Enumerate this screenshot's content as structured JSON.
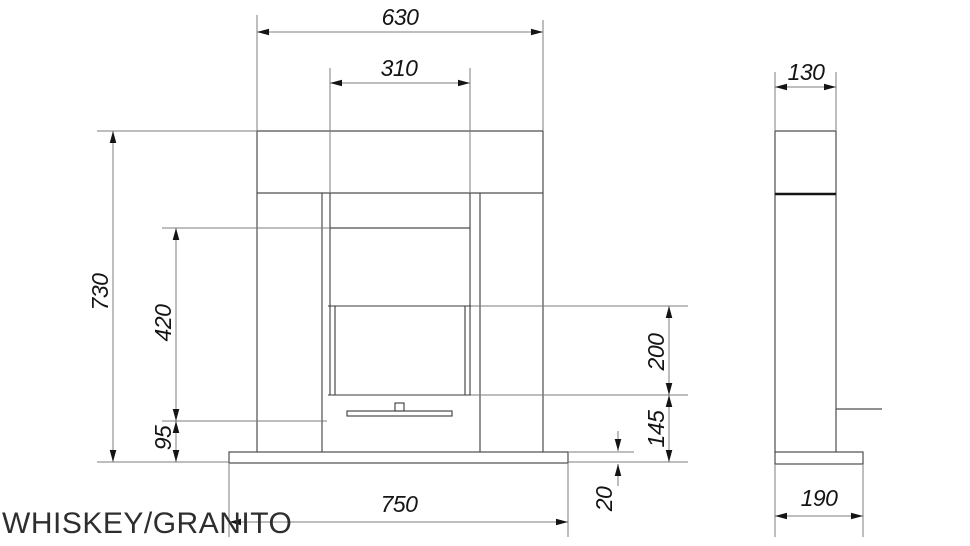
{
  "title": "WHISKEY/GRANITO",
  "drawing_type": "fireplace technical drawing, front and side orthographic views",
  "colors": {
    "object_line": "#4d4d4d",
    "detail_line": "#3a3a3a",
    "dim_line": "#7d7d7d",
    "arrow_and_text": "#141414",
    "title_text": "#2e2e2e",
    "background": "#ffffff"
  },
  "front_view": {
    "dims": {
      "mantel_width": "630",
      "opening_width": "310",
      "overall_height": "730",
      "opening_height": "420",
      "burner_to_floor": "95",
      "glass_height": "200",
      "glass_bottom_to_floor": "145",
      "base_thickness": "20",
      "base_width": "750"
    }
  },
  "side_view": {
    "dims": {
      "body_depth": "130",
      "base_depth": "190"
    }
  }
}
